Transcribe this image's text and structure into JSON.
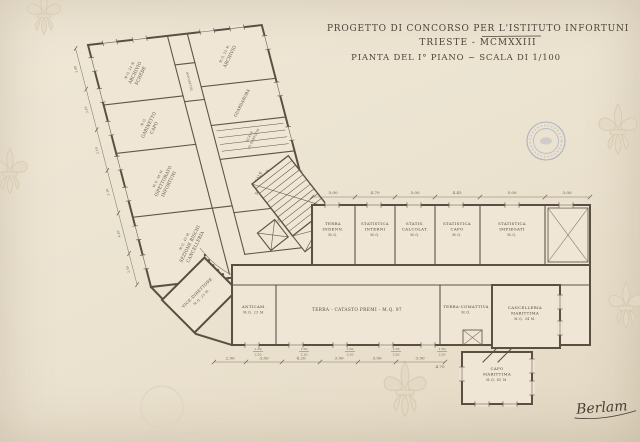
{
  "colors": {
    "paper": "#ece3d1",
    "ink": "#554a3d",
    "stamp_blue": "#7282b8"
  },
  "title": {
    "line1": "PROGETTO DI CONCORSO PER L'ISTITUTO INFORTUNI",
    "line2": "TRIESTE - MCMXXIII",
    "line3": "PIANTA DEL I° PIANO ~ SCALA DI 1/100"
  },
  "rooms": {
    "wing": {
      "archivio_schede": {
        "area": "M.Q. 24 M.",
        "l1": "ARCHIVIO",
        "l2": "SCHEDE"
      },
      "gabinetto_capo": {
        "area": "M.Q.",
        "l1": "GABINETTO",
        "l2": "CAPO"
      },
      "ispettorato": {
        "area": "M.Q. 46 M.",
        "l1": "ISPETTORATO",
        "l2": "INFORTUNI"
      },
      "sezione_rischi": {
        "area": "M.Q. 40 M.",
        "l1": "SEZIONE RISCHI",
        "l2": "CANCELLERIA"
      },
      "archivio": {
        "area": "M.Q. 22 M.",
        "l1": "ARCHIVIO"
      },
      "guardaroba_1": {
        "l1": "GUARDAROBA"
      },
      "scala_servizio": {
        "l1": "SCALA",
        "l2": "DI SERVIZIO"
      },
      "locale_servizio": {
        "l1": "LOCALE",
        "l2": "DI SERVIZIO",
        "area": "M.Q. 22 M."
      },
      "guardaroba_2": {
        "l1": "GUARDAROBA"
      },
      "telefono": {
        "l1": "TELEFONO"
      },
      "vice_direttore": {
        "l1": "VICE-DIRETTORE",
        "area": "M.Q. 23 M."
      }
    },
    "band": {
      "terra_indenn": {
        "l1": "TERRA",
        "l2": "INDENN.",
        "area": "M.Q."
      },
      "statistica_interni": {
        "l1": "STATISTICA",
        "l2": "INTERNI",
        "area": "M.Q."
      },
      "statistica_calcolat": {
        "l1": "STATIS.",
        "l2": "CALCOLAT.",
        "area": "M.Q."
      },
      "statistica_capo": {
        "l1": "STATISTICA",
        "l2": "CAPO",
        "area": "M.Q."
      },
      "statistica_impiegati": {
        "l1": "STATISTICA",
        "l2": "IMPIEGATI",
        "area": "M.Q."
      }
    },
    "south": {
      "anticamera": {
        "l1": "ANTICAM.",
        "area": "M.Q. 23 M."
      },
      "catasto_premi": {
        "l1": "TERRA - CATASTO PREMI - M.Q. 97"
      },
      "comattiva": {
        "l1": "TERRA-COMATTIVA",
        "area": "M.Q."
      },
      "cancelleria_marittima": {
        "l1": "CANCELLERIA",
        "l2": "MARITTIMA",
        "area": "M.Q. 34 M."
      },
      "capo_marittima": {
        "l1": "CAPO",
        "l2": "MARITTIMA",
        "area": "M.Q. 45 M."
      }
    }
  },
  "dims": {
    "top": [
      "5.00",
      "4.70",
      "5.00",
      "4.45",
      "5.00",
      "3.00"
    ],
    "bottom": [
      "2.90",
      "3.50",
      "4.20",
      "3.90",
      "3.90",
      "3.90",
      "4.70"
    ],
    "window": {
      "w": "1.50",
      "h": "2.20"
    },
    "wing": [
      "2.80",
      "3.10",
      "2.10",
      "3.10",
      "4.20",
      "3.50"
    ]
  },
  "signature": "Berlam"
}
